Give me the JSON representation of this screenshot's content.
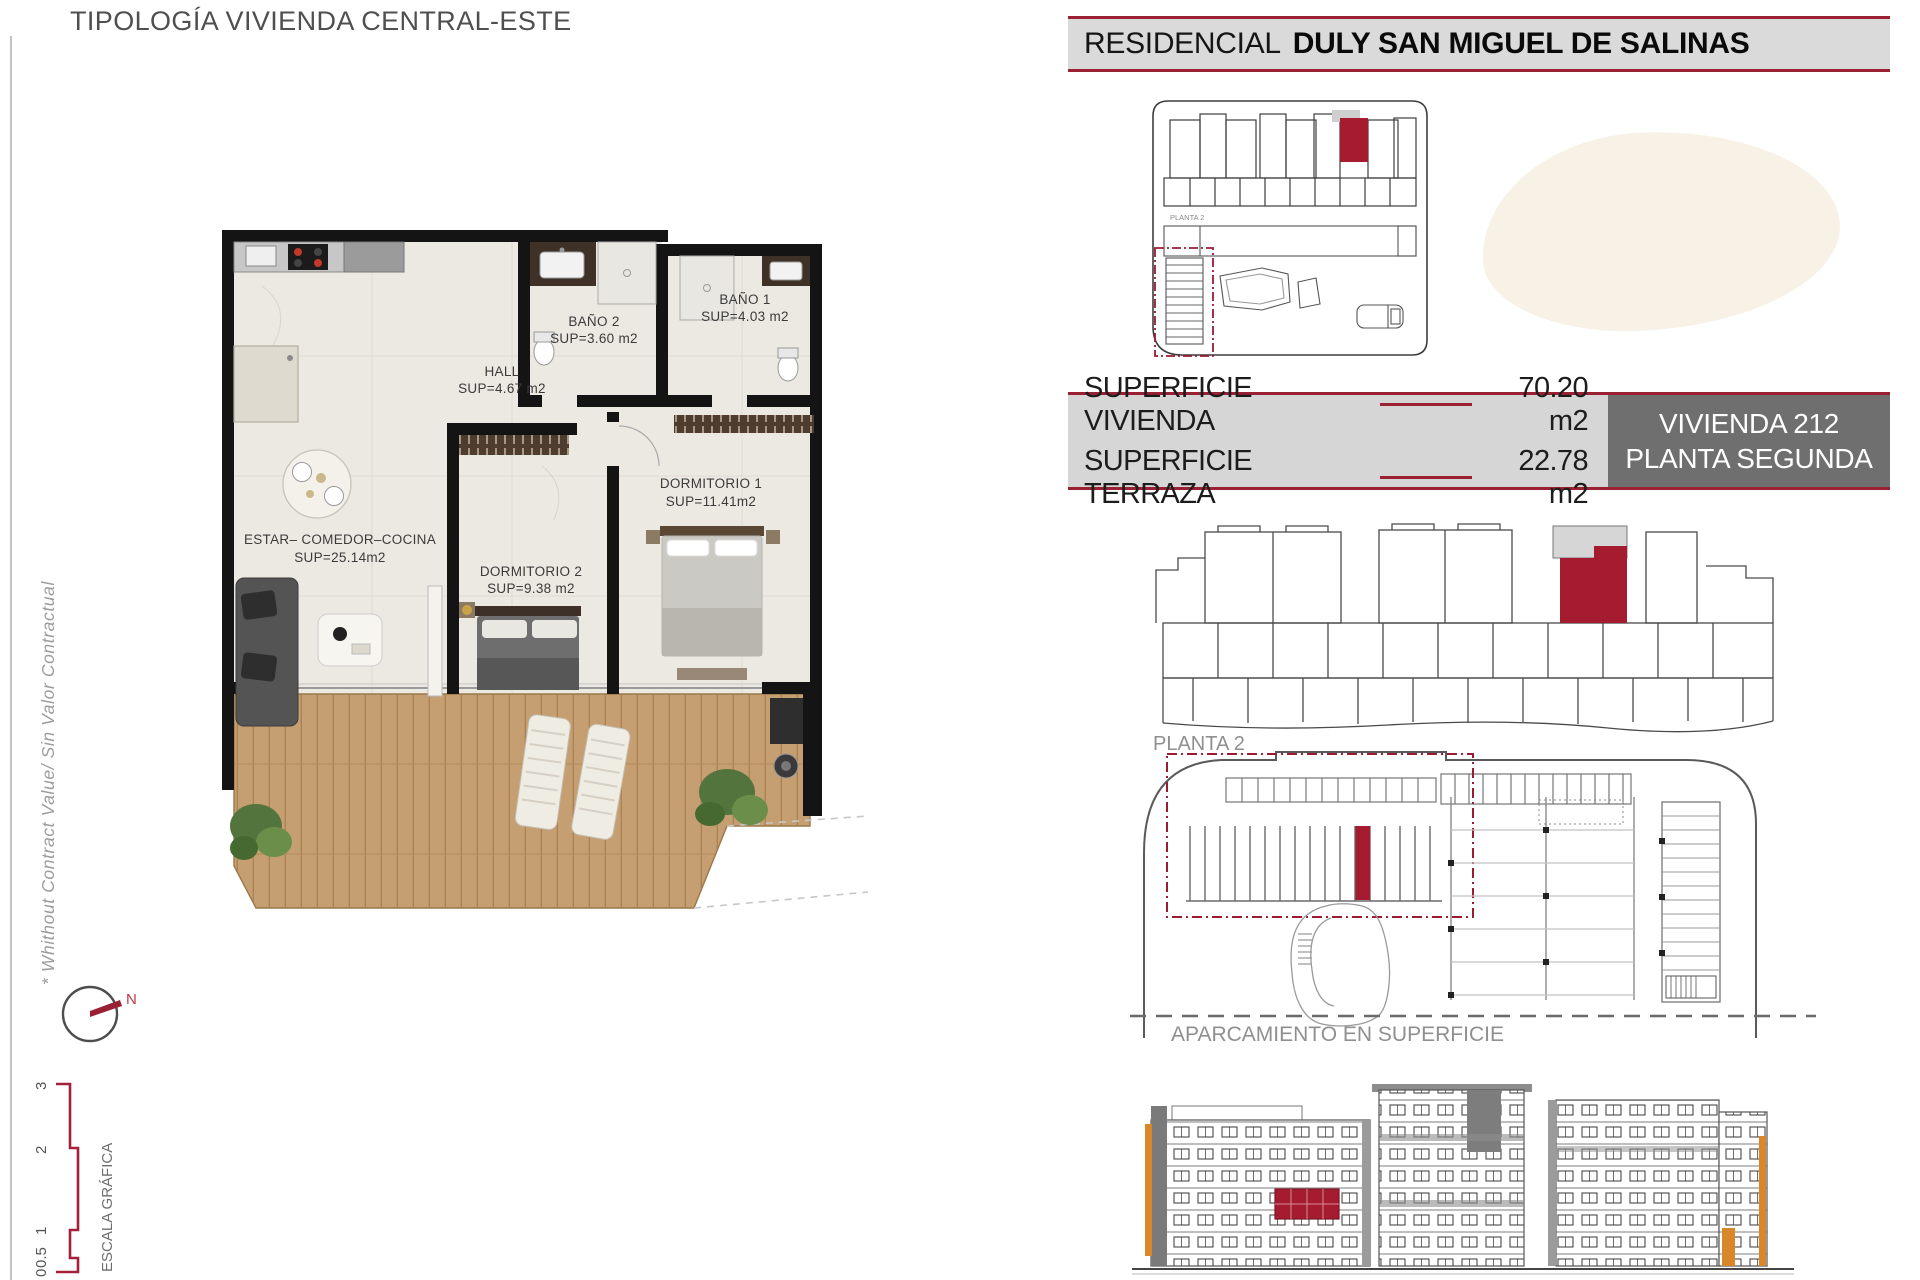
{
  "page": {
    "title": "TIPOLOGÍA VIVIENDA CENTRAL-ESTE"
  },
  "header": {
    "prefix": "RESIDENCIAL",
    "name": "DULY SAN MIGUEL DE SALINAS"
  },
  "floorplan": {
    "rooms": [
      {
        "name": "HALL",
        "sup": "SUP=4.67 m2"
      },
      {
        "name": "BAÑO 2",
        "sup": "SUP=3.60 m2"
      },
      {
        "name": "BAÑO 1",
        "sup": "SUP=4.03 m2"
      },
      {
        "name": "DORMITORIO 1",
        "sup": "SUP=11.41m2"
      },
      {
        "name": "DORMITORIO 2",
        "sup": "SUP=9.38 m2"
      },
      {
        "name": "ESTAR– COMEDOR–COCINA",
        "sup": "SUP=25.14m2"
      }
    ],
    "side_note": "* Whithout Contract Value/ Sin Valor Contractual",
    "compass_label": "N"
  },
  "surface_table": {
    "rows": [
      {
        "label": "SUPERFICIE VIVIENDA",
        "value": "70.20 m2"
      },
      {
        "label": "SUPERFICIE TERRAZA",
        "value": "22.78 m2"
      }
    ],
    "unit": {
      "line1": "VIVIENDA 212",
      "line2": "PLANTA SEGUNDA"
    }
  },
  "siteplan": {
    "label": "PLANTA 2"
  },
  "keyplan": {
    "label": "PLANTA 2"
  },
  "parking": {
    "label": "APARCAMIENTO EN SUPERFICIE"
  },
  "scalebar": {
    "title": "ESCALA GRÁFICA",
    "ticks": [
      "0",
      "0.5",
      "1",
      "2",
      "3"
    ]
  },
  "colors": {
    "accent": "#9A2133",
    "unit_red": "#A51C30",
    "header_bg": "#DADADA",
    "table_dark_bg": "#6F6F6F",
    "beige": "#F7F1E6",
    "wood": "#C59E71"
  }
}
